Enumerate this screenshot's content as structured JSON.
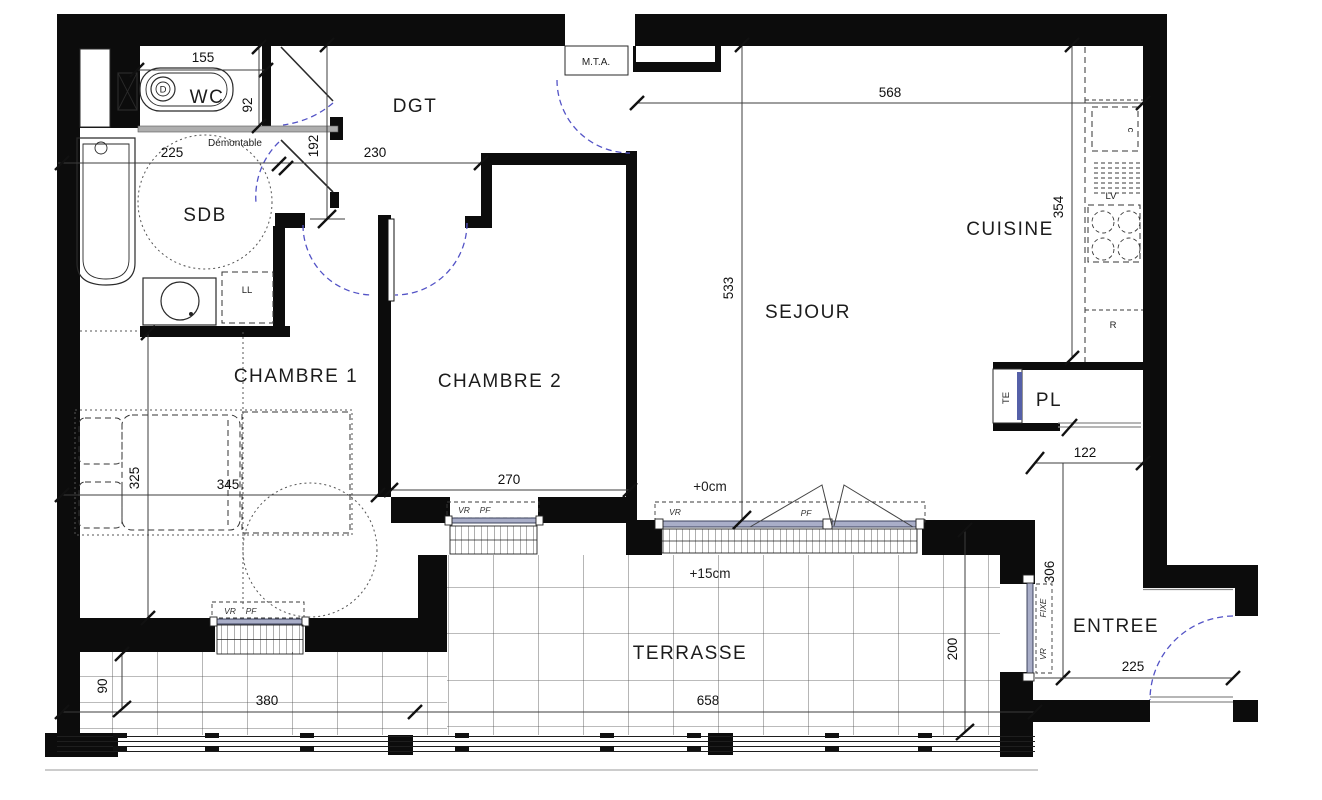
{
  "rooms": {
    "wc": "WC",
    "dgt": "DGT",
    "sdb": "SDB",
    "cuisine": "CUISINE",
    "sejour": "SEJOUR",
    "chambre1": "CHAMBRE 1",
    "chambre2": "CHAMBRE 2",
    "pl": "PL",
    "entree": "ENTREE",
    "terrasse": "TERRASSE"
  },
  "dims": {
    "wc_width": "155",
    "wc_depth": "92",
    "dgt_depth": "192",
    "sdb_width": "225",
    "dgt_width": "230",
    "chambre2_width": "270",
    "chambre1_width": "345",
    "chambre1_depth": "325",
    "sejour_width": "568",
    "sejour_depth": "533",
    "cuisine_depth": "354",
    "pl_recess": "122",
    "entree_depth": "306",
    "entree_width": "225",
    "terrasse_width": "658",
    "terrasse_left_width": "380",
    "terrasse_left_depth": "90",
    "terrasse_depth": "200"
  },
  "levels": {
    "sejour": "+0cm",
    "terrasse": "+15cm"
  },
  "fixtures": {
    "mta": "M.T.A.",
    "demontable": "Démontable",
    "te": "TE",
    "ll": "LL",
    "lv": "LV",
    "cooker": "c",
    "fridge": "R",
    "toilet": "D"
  },
  "windows": {
    "vr": "VR",
    "pf": "PF",
    "fixe": "FIXE"
  },
  "colors": {
    "wall": "#0c0c0c",
    "dimension_line": "#3c3c3c",
    "door_arc": "#5353c6",
    "glazing_fill": "#a9aec8",
    "glazing_edge": "#2e3550",
    "demountable_wall": "#aeaeae",
    "tile_line": "#4a4a4a",
    "text": "#1c1c1c"
  }
}
